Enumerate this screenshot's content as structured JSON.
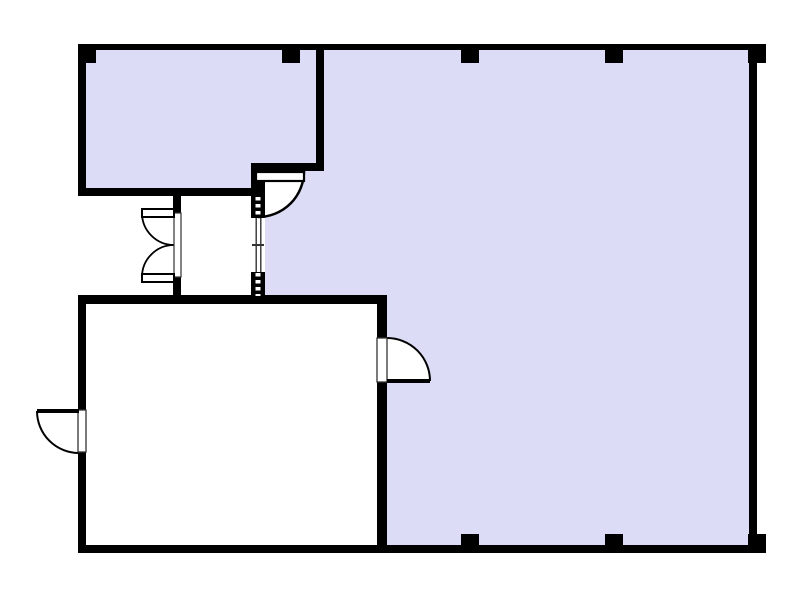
{
  "floor_plan": {
    "canvas": {
      "width": 800,
      "height": 600,
      "background": "#ffffff"
    },
    "colors": {
      "wall": "#000000",
      "room_fill": "#dcdcf6",
      "swing_fill": "#ffffff",
      "arc_stroke": "#000000",
      "leaf_fill": "#ffffff",
      "leaf_stroke": "#000000",
      "opening_stroke": "#333333",
      "window_line": "#333333",
      "track_dash": "#ffffff"
    },
    "layers": [
      {
        "name": "rooms",
        "defaults": {
          "fill": "#dcdcf6"
        },
        "items": [
          {
            "name": "room-upper-left",
            "d": "M86,50 H316 V163 H251 V188 H86 Z"
          },
          {
            "name": "room-main",
            "d": "M324,50 H749 V545 H387 V295 H265 V171 H324 Z"
          }
        ]
      },
      {
        "name": "door-swings",
        "defaults": {
          "fill": "#ffffff"
        },
        "items": [
          {
            "name": "door-swing-top-middle",
            "d": "M258,171 L304,171 A46,46 0 0 1 258,217 Z"
          },
          {
            "name": "door-swing-vestibule-upper",
            "d": "M174,213 L142,213 A32,32 0 0 0 174,245 Z"
          },
          {
            "name": "door-swing-vestibule-lower",
            "d": "M174,277 L142,277 A32,32 0 0 1 174,245 Z"
          },
          {
            "name": "door-swing-exterior-left",
            "d": "M79,411 L37,411 A42,42 0 0 0 79,453 Z"
          },
          {
            "name": "door-swing-lower-room",
            "d": "M387,381 L387,338 A43,43 0 0 1 430,381 Z"
          }
        ]
      },
      {
        "name": "walls",
        "defaults": {
          "fill": "#000000"
        },
        "items": [
          {
            "name": "wall-outer-top",
            "rect": [
              78,
              44,
              688,
              6
            ]
          },
          {
            "name": "wall-outer-bottom",
            "rect": [
              78,
              545,
              688,
              8
            ]
          },
          {
            "name": "wall-outer-left-upper",
            "rect": [
              78,
              44,
              8,
              152
            ]
          },
          {
            "name": "wall-outer-left-lower-a",
            "rect": [
              78,
              295,
              8,
              115
            ]
          },
          {
            "name": "wall-outer-left-lower-b",
            "rect": [
              78,
              452,
              8,
              101
            ]
          },
          {
            "name": "wall-outer-right",
            "rect": [
              749,
              44,
              8,
              509
            ]
          },
          {
            "name": "wall-upper-room-right",
            "rect": [
              316,
              44,
              8,
              127
            ]
          },
          {
            "name": "wall-notch-horizontal",
            "rect": [
              251,
              163,
              73,
              8
            ]
          },
          {
            "name": "wall-upper-room-bottom",
            "rect": [
              78,
              188,
              187,
              8
            ]
          },
          {
            "name": "wall-vestibule-left-top",
            "rect": [
              173,
              196,
              8,
              17
            ]
          },
          {
            "name": "wall-vestibule-left-bottom",
            "rect": [
              173,
              277,
              8,
              27
            ]
          },
          {
            "name": "wall-vestibule-right-top",
            "rect": [
              251,
              171,
              14,
              25
            ]
          },
          {
            "name": "wall-lower-room-top",
            "rect": [
              78,
              295,
              309,
              9
            ]
          },
          {
            "name": "wall-lower-room-right-a",
            "rect": [
              377,
              295,
              10,
              43
            ]
          },
          {
            "name": "wall-lower-room-right-b",
            "rect": [
              377,
              382,
              10,
              171
            ]
          }
        ]
      },
      {
        "name": "posts",
        "defaults": {
          "fill": "#000000"
        },
        "items": [
          {
            "name": "column-post-top-left",
            "rect": [
              78,
              44,
              18,
              19
            ]
          },
          {
            "name": "column-post-top-a",
            "rect": [
              282,
              44,
              18,
              19
            ]
          },
          {
            "name": "column-post-top-b",
            "rect": [
              461,
              44,
              18,
              19
            ]
          },
          {
            "name": "column-post-top-c",
            "rect": [
              605,
              44,
              18,
              19
            ]
          },
          {
            "name": "column-post-top-right",
            "rect": [
              748,
              44,
              18,
              19
            ]
          },
          {
            "name": "column-post-bottom-a",
            "rect": [
              461,
              534,
              18,
              19
            ]
          },
          {
            "name": "column-post-bottom-b",
            "rect": [
              605,
              534,
              18,
              19
            ]
          },
          {
            "name": "column-post-bottom-right",
            "rect": [
              748,
              534,
              18,
              19
            ]
          }
        ]
      },
      {
        "name": "track-base",
        "defaults": {
          "fill": "#000000"
        },
        "items": [
          {
            "name": "sliding-track-upper",
            "rect": [
              251,
              196,
              14,
              22
            ]
          },
          {
            "name": "sliding-track-lower",
            "rect": [
              251,
              272,
              14,
              25
            ]
          }
        ]
      },
      {
        "name": "track-dashes",
        "defaults": {
          "stroke": "#ffffff",
          "sw": 5,
          "dash": "3.5 3.5",
          "fill": "none"
        },
        "items": [
          {
            "name": "sliding-track-upper-dashes",
            "line": [
              258,
              197,
              258,
              217
            ]
          },
          {
            "name": "sliding-track-lower-dashes",
            "line": [
              258,
              273,
              258,
              296
            ]
          }
        ]
      },
      {
        "name": "window-base",
        "defaults": {
          "fill": "#ffffff"
        },
        "items": [
          {
            "name": "window-panel",
            "rect": [
              251,
              218,
              14,
              54
            ]
          }
        ]
      },
      {
        "name": "window-lines",
        "defaults": {
          "stroke": "#333333",
          "sw": 1.4,
          "fill": "none"
        },
        "items": [
          {
            "name": "window-line-left",
            "d": "M256.2,218 V272"
          },
          {
            "name": "window-line-right",
            "d": "M260.8,218 V272"
          },
          {
            "name": "window-center-tick",
            "d": "M252,245 H264",
            "sw": 2
          }
        ]
      },
      {
        "name": "door-arcs",
        "defaults": {
          "stroke": "#000000",
          "fill": "none",
          "sw": 2
        },
        "items": [
          {
            "name": "door-arc-top-middle",
            "d": "M304,171 A46,46 0 0 1 258,217",
            "sw": 2.5
          },
          {
            "name": "door-arc-vestibule-upper",
            "d": "M142,213 A32,32 0 0 0 174,245",
            "sw": 1.8
          },
          {
            "name": "door-arc-vestibule-lower",
            "d": "M142,277 A32,32 0 0 1 174,245",
            "sw": 1.8
          },
          {
            "name": "door-arc-exterior-left",
            "d": "M37,411 A42,42 0 0 0 79,453"
          },
          {
            "name": "door-arc-lower-room",
            "d": "M387,338 A43,43 0 0 1 430,381"
          }
        ]
      },
      {
        "name": "door-openings",
        "defaults": {
          "fill": "#ffffff",
          "stroke": "#333333",
          "sw": 1.3
        },
        "items": [
          {
            "name": "door-closed-leaves-vestibule",
            "rect": [
              174,
              213,
              7,
              64
            ],
            "sw": 1.2
          },
          {
            "name": "door-opening-exterior-left",
            "rect": [
              78,
              410,
              8,
              42
            ]
          },
          {
            "name": "door-opening-lower-room",
            "rect": [
              377,
              338,
              10,
              44
            ]
          }
        ]
      },
      {
        "name": "door-leaves",
        "defaults": {
          "fill": "#ffffff",
          "stroke": "#000000",
          "sw": 2
        },
        "items": [
          {
            "name": "door-leaf-top-middle",
            "rect": [
              256,
              172,
              48,
              9
            ],
            "sw": 2.2
          },
          {
            "name": "door-leaf-vestibule-upper",
            "rect": [
              142,
              209,
              32,
              8
            ]
          },
          {
            "name": "door-leaf-vestibule-lower",
            "rect": [
              142,
              274,
              32,
              8
            ]
          }
        ]
      },
      {
        "name": "door-open-lines",
        "defaults": {
          "fill": "#000000"
        },
        "items": [
          {
            "name": "door-open-line-exterior-left",
            "rect": [
              37,
              409,
              42,
              4
            ]
          },
          {
            "name": "door-open-line-lower-room",
            "rect": [
              387,
              379,
              43,
              4
            ]
          }
        ]
      }
    ]
  }
}
